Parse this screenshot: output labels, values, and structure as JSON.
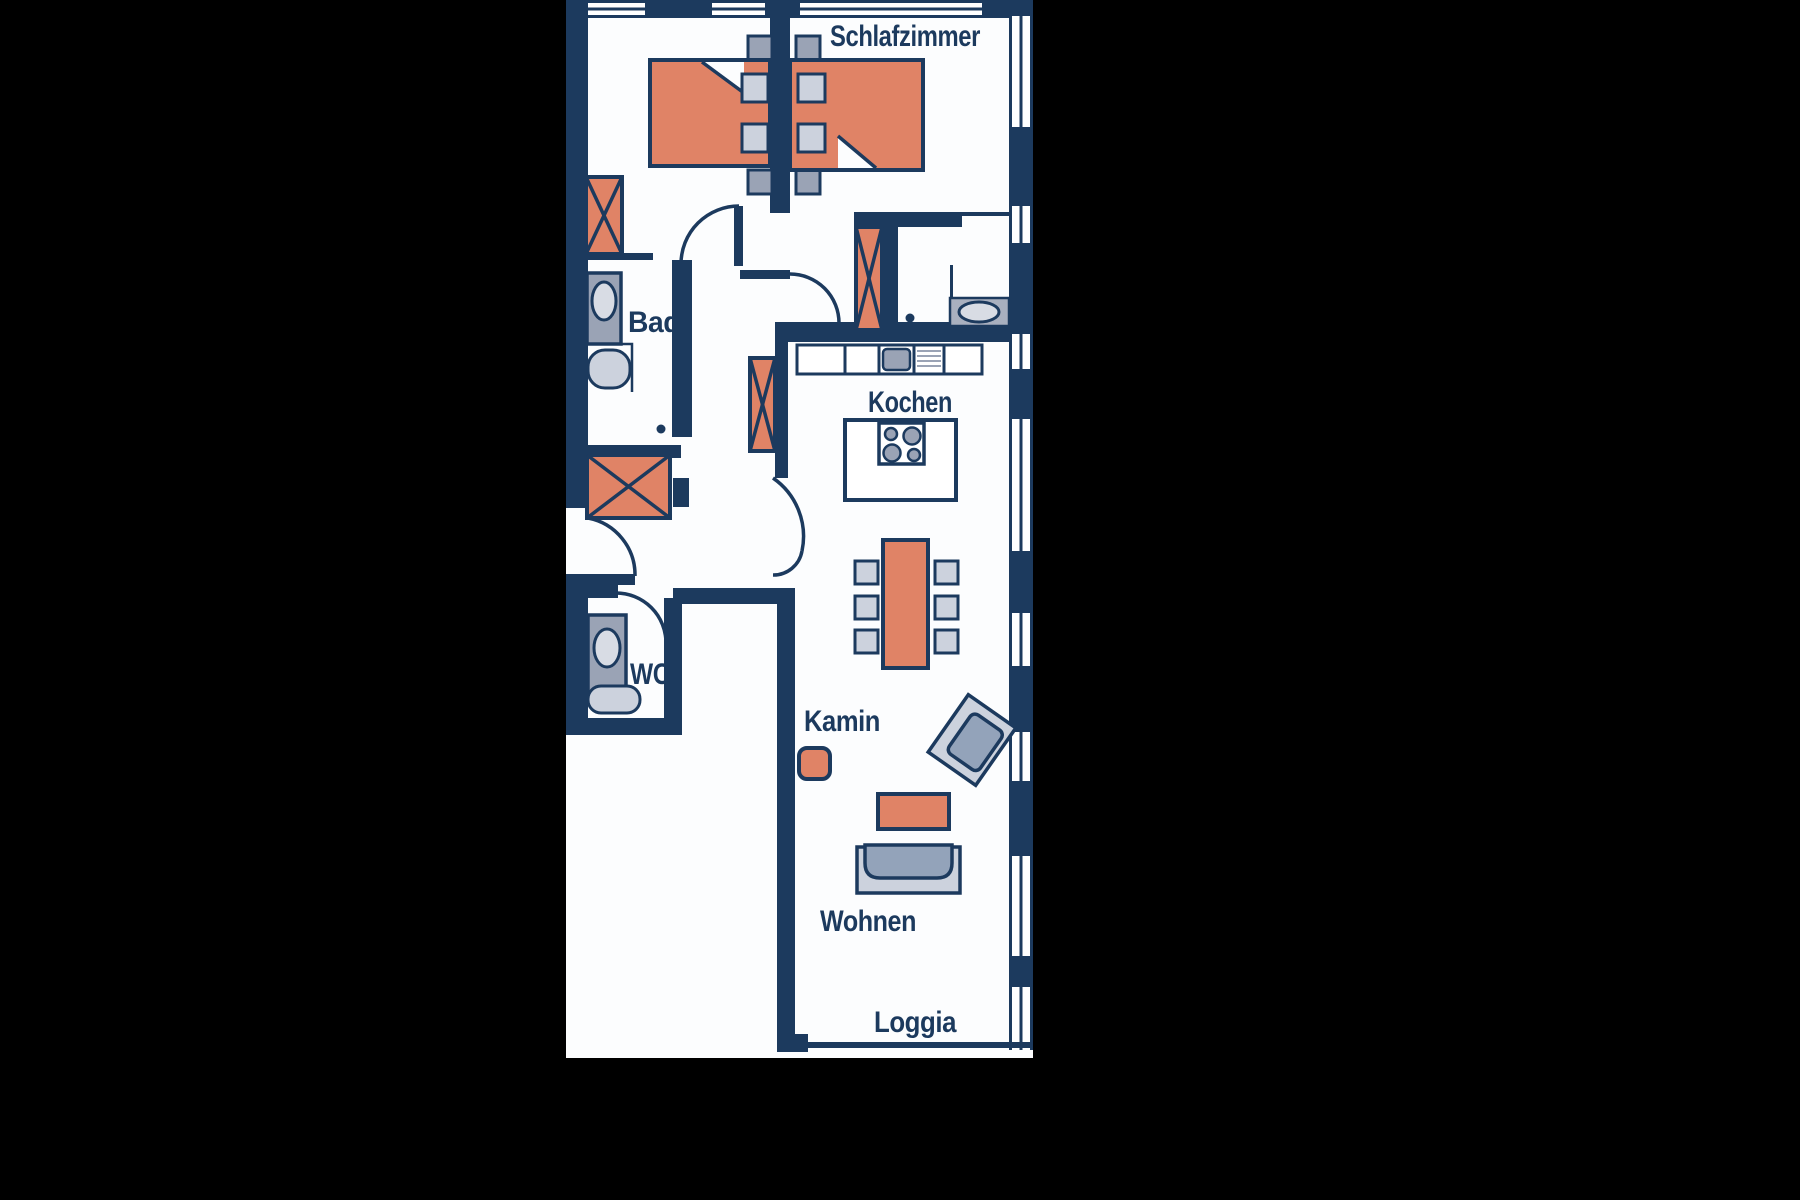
{
  "title": "Apartment floor plan",
  "labels": {
    "schlafzimmer": "Schlafzimmer",
    "bad": "Bad",
    "kochen": "Kochen",
    "wc": "WC",
    "kamin": "Kamin",
    "wohnen": "Wohnen",
    "loggia": "Loggia"
  },
  "colors": {
    "wall_and_text": "#1c3a5e",
    "furniture_accent": "#e08366",
    "fixture_gray": "#9aa3b5",
    "seat_light_gray": "#ccd2dd",
    "sofa_blue_gray": "#93a3ba",
    "floor_white": "#fcfdfe",
    "background": "#000000"
  },
  "furniture": [
    "double-bed-left",
    "double-bed-right",
    "nightstands",
    "wardrobes-x-symbol",
    "bathtub",
    "bathroom-sink",
    "toilet",
    "wc-sink",
    "kitchen-counter",
    "kitchen-sink",
    "drainboard",
    "stove-island",
    "dining-table",
    "six-chairs",
    "fireplace",
    "armchair",
    "coffee-table",
    "sofa"
  ]
}
